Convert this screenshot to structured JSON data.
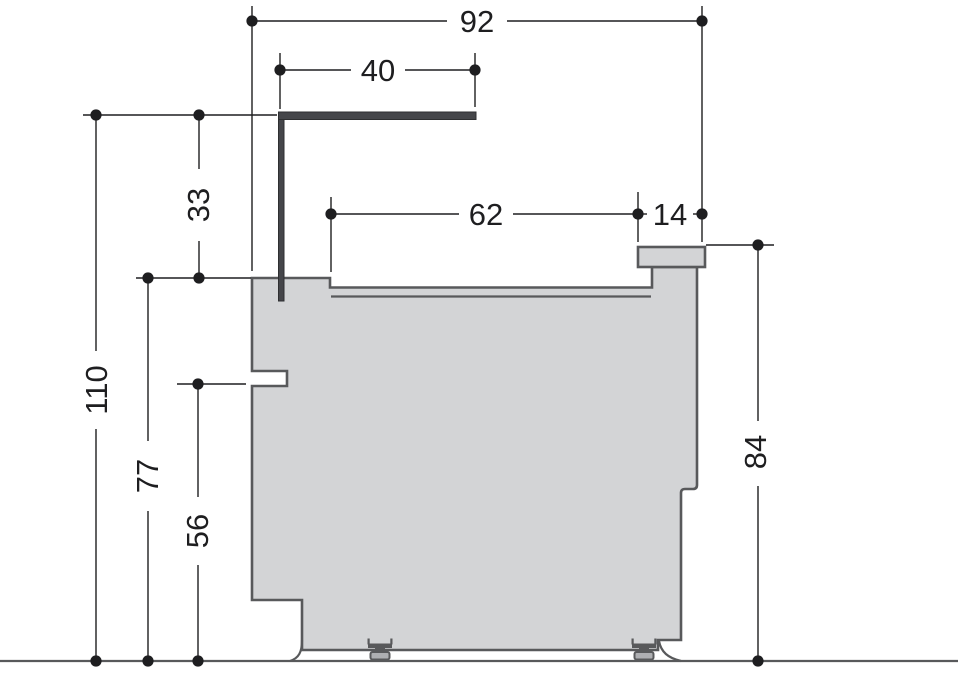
{
  "diagram": {
    "kind": "technical-side-elevation-with-dimensions",
    "dims": {
      "overall_width": {
        "label": "92"
      },
      "rail_length": {
        "label": "40"
      },
      "rail_to_body_top": {
        "label": "33"
      },
      "top_recess_width": {
        "label": "62"
      },
      "cap_width": {
        "label": "14"
      },
      "rail_top_height": {
        "label": "110"
      },
      "body_top_height": {
        "label": "77"
      },
      "notch_height": {
        "label": "56"
      },
      "cap_top_height": {
        "label": "84"
      }
    },
    "colors": {
      "background": "#ffffff",
      "body_fill": "#d3d4d6",
      "body_stroke": "#58595b",
      "rail": "#45464a",
      "dimension_ink": "#1e1e20"
    }
  }
}
